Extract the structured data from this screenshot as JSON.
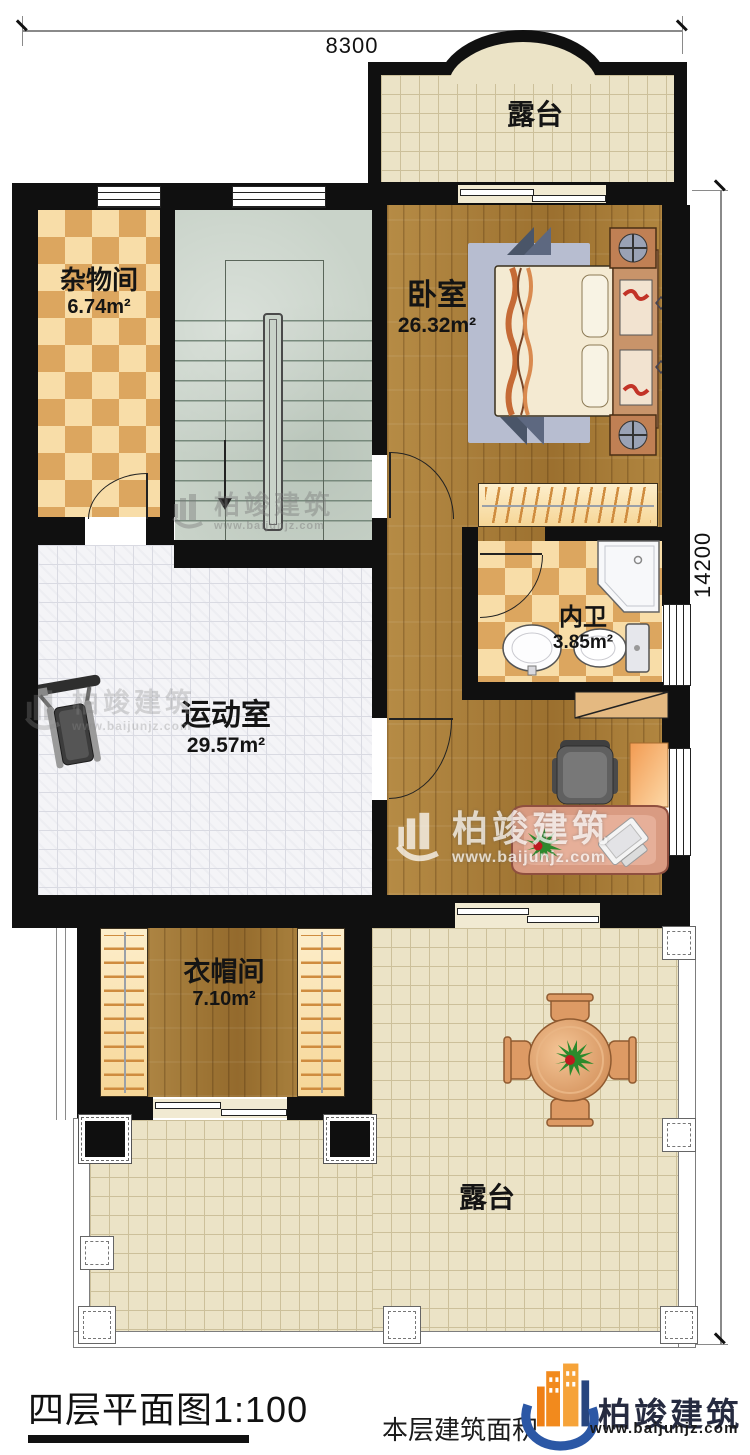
{
  "dimensions": {
    "width_top": "8300",
    "height_right": "14200"
  },
  "rooms": {
    "terrace_top": {
      "name": "露台"
    },
    "storage": {
      "name": "杂物间",
      "area": "6.74m²"
    },
    "bedroom": {
      "name": "卧室",
      "area": "26.32m²"
    },
    "bathroom": {
      "name": "内卫",
      "area": "3.85m²"
    },
    "gym": {
      "name": "运动室",
      "area": "29.57m²"
    },
    "cloakroom": {
      "name": "衣帽间",
      "area": "7.10m²"
    },
    "terrace_bottom": {
      "name": "露台"
    }
  },
  "footer": {
    "title": "四层平面图1:100",
    "area_label": "本层建筑面积",
    "brand": "柏竣建筑",
    "website": "www.baijunjz.com"
  },
  "watermark": {
    "brand": "柏竣建筑",
    "website": "www.baijunjz.com"
  },
  "colors": {
    "wall": "#101010",
    "wood": "#a87c36",
    "checker_light": "#f8dda8",
    "checker_dark": "#dca65f",
    "terrace": "#ebe3c6",
    "tile": "#f4f4f7",
    "stair": "#c9d3c9",
    "brand_orange": "#f28a1d",
    "brand_blue": "#2b57a5"
  }
}
